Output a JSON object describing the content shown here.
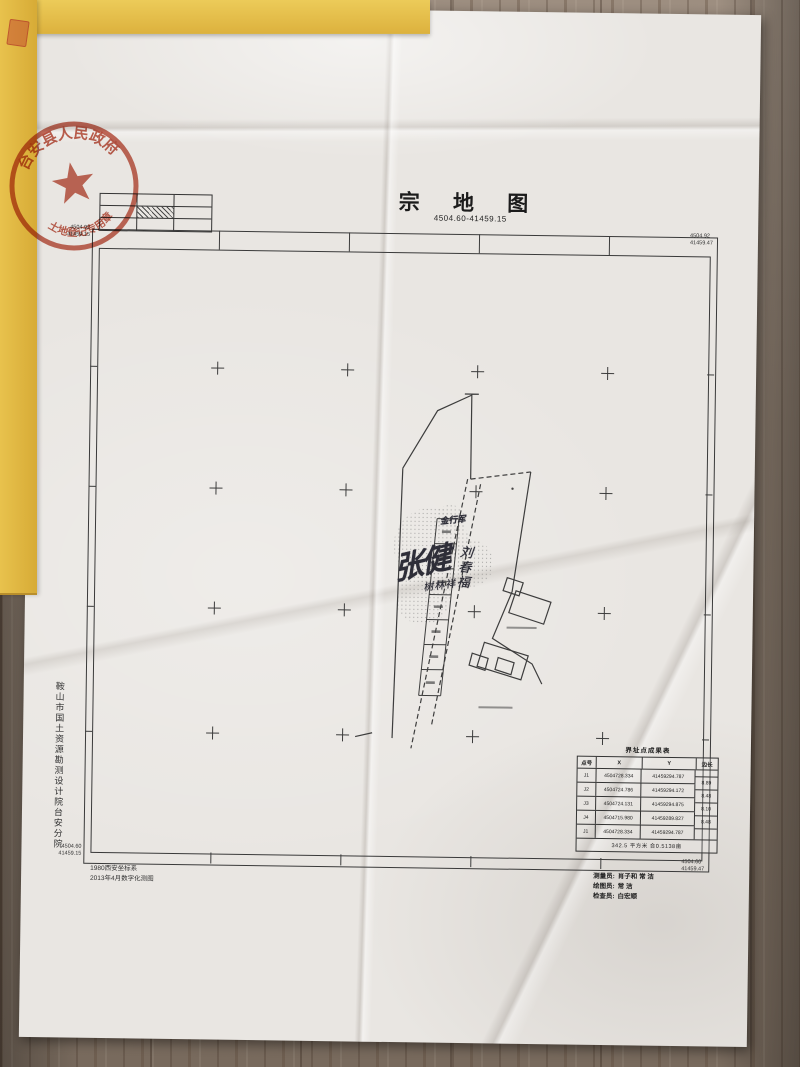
{
  "colors": {
    "seal_red": "#b8432f",
    "folder_yellow": "#e4bd4a",
    "paper": "#e9e6e2",
    "wood": "#8b7c6e",
    "map_line": "#3a3a3a"
  },
  "seal": {
    "top_text": "台安县人民政府",
    "bottom_text": "土地登记专用章"
  },
  "sheet": {
    "title": "宗 地 图",
    "number": "4504.60-41459.15",
    "corners": {
      "tl": [
        "4504.92",
        "41459.15"
      ],
      "tr": [
        "4504.92",
        "41459.47"
      ],
      "bl": [
        "4504.60",
        "41459.15"
      ],
      "br": [
        "4504.60",
        "41459.47"
      ]
    },
    "index_grid": {
      "rows": 3,
      "cols": 3,
      "hatched_cell": "center"
    },
    "handwriting": {
      "signature": "张健",
      "right_name": "刘春福",
      "small_name": "树林祥",
      "box_label": "金行军"
    },
    "table": {
      "title": "界址点成果表",
      "headers": [
        "点号",
        "X",
        "Y",
        "边长"
      ],
      "rows": [
        [
          "J1",
          "4504728.334",
          "41459294.787"
        ],
        [
          "J2",
          "4504724.786",
          "41459294.172"
        ],
        [
          "J3",
          "4504724.131",
          "41459294.875"
        ],
        [
          "J4",
          "4504715.980",
          "41459289.827"
        ],
        [
          "J1",
          "4504728.334",
          "41459294.787"
        ]
      ],
      "edges": [
        "8.89",
        "8.48",
        "8.10",
        "8.48"
      ],
      "summary": "342.5 平方米 合0.5138亩"
    },
    "notes": [
      "1980西安坐标系",
      "2013年4月数字化测图"
    ],
    "staff": [
      {
        "label": "测量员:",
        "value": "肖子和 常 洁"
      },
      {
        "label": "绘图员:",
        "value": "常 洁"
      },
      {
        "label": "检查员:",
        "value": "白宏顺"
      }
    ],
    "agency": "鞍山市国土资源勘测设计院台安分院"
  }
}
